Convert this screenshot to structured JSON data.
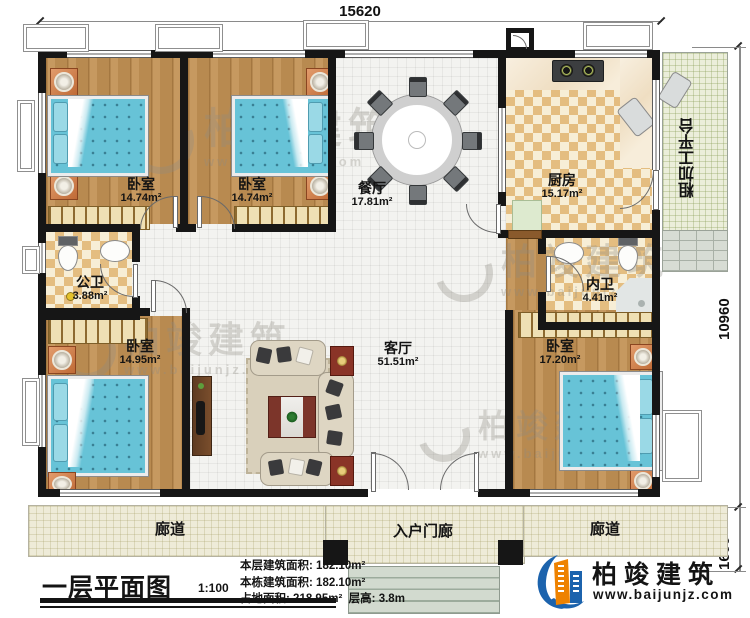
{
  "plan": {
    "dim_top": "15620",
    "dim_right_main": "10960",
    "dim_right_porch": "1600"
  },
  "rooms": {
    "bedroom_tl": {
      "label": "卧室",
      "area": "14.74m²"
    },
    "bedroom_tm": {
      "label": "卧室",
      "area": "14.74m²"
    },
    "dining": {
      "label": "餐厅",
      "area": "17.81m²"
    },
    "kitchen": {
      "label": "厨房",
      "area": "15.17m²"
    },
    "platform": {
      "label": "粗加工平台"
    },
    "public_bath": {
      "label": "公卫",
      "area": "3.88m²"
    },
    "inner_bath": {
      "label": "内卫",
      "area": "4.41m²"
    },
    "bedroom_bl": {
      "label": "卧室",
      "area": "14.95m²"
    },
    "bedroom_br": {
      "label": "卧室",
      "area": "17.20m²"
    },
    "living": {
      "label": "客厅",
      "area": "51.51m²"
    },
    "corridor_left": {
      "label": "廊道"
    },
    "corridor_right": {
      "label": "廊道"
    },
    "entry_porch": {
      "label": "入户门廊"
    }
  },
  "title_block": {
    "title": "一层平面图",
    "scale": "1:100",
    "floor_area_label": "本层建筑面积:",
    "floor_area_value": "182.10m²",
    "building_area_label": "本栋建筑面积:",
    "building_area_value": "182.10m²",
    "land_area_label": "占地面积:",
    "land_area_value": "218.95m²",
    "storey_height_label": "层高:",
    "storey_height_value": "3.8m"
  },
  "branding": {
    "company": "柏竣建筑",
    "website": "www.baijunjz.com",
    "brand_blue": "#1c63ad",
    "brand_orange": "#ee8200"
  },
  "watermark": {
    "company": "柏竣建筑",
    "website": "www.baijunjz.com"
  }
}
